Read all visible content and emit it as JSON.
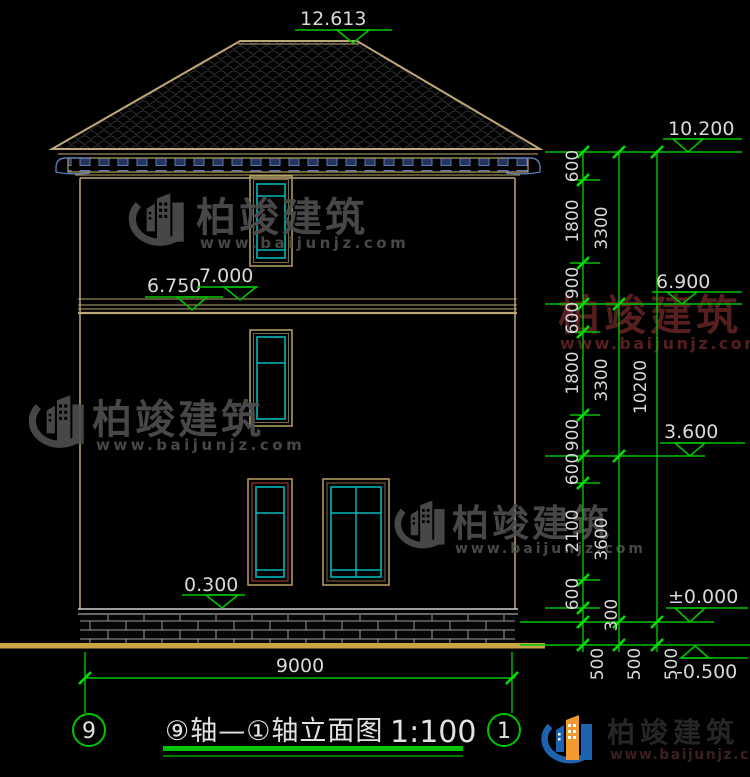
{
  "title": {
    "text": "⑨轴—①轴立面图",
    "scale": "1:100",
    "axis_left": "9",
    "axis_right": "1"
  },
  "elevations": {
    "ridge": "12.613",
    "eave": "10.200",
    "band_left_low": "6.750",
    "band_left_high": "7.000",
    "floor2": "6.900",
    "floor1": "3.600",
    "plinth": "0.300",
    "ground": "±0.000",
    "base": "-0.500"
  },
  "dims": {
    "col1": [
      "600",
      "1800",
      "900",
      "600",
      "1800",
      "900",
      "600",
      "2100",
      "600",
      "300"
    ],
    "col2": [
      "3300",
      "3300",
      "3600"
    ],
    "col3": [
      "10200"
    ],
    "base_offsets": [
      "500",
      "500",
      "500"
    ],
    "width": "9000"
  },
  "watermark": {
    "brand": "柏竣建筑",
    "site": "www.baijunjz.com"
  },
  "logo": {
    "brand": "柏竣建筑",
    "site": "www.baijunjz.com"
  },
  "colors": {
    "background": "#000000",
    "outline_tan": "#bda878",
    "dim_green": "#00c400",
    "tick_green": "#00e000",
    "text_white": "#d9d9d9",
    "window_cyan": "#00b8b8",
    "rafter_blue": "#24355c",
    "watermark_gray": "#4e4e4e",
    "watermark_red": "#5e2121",
    "logo_blue": "#1e63b0",
    "logo_orange": "#f09a30",
    "ground_tan": "#c9a545"
  }
}
